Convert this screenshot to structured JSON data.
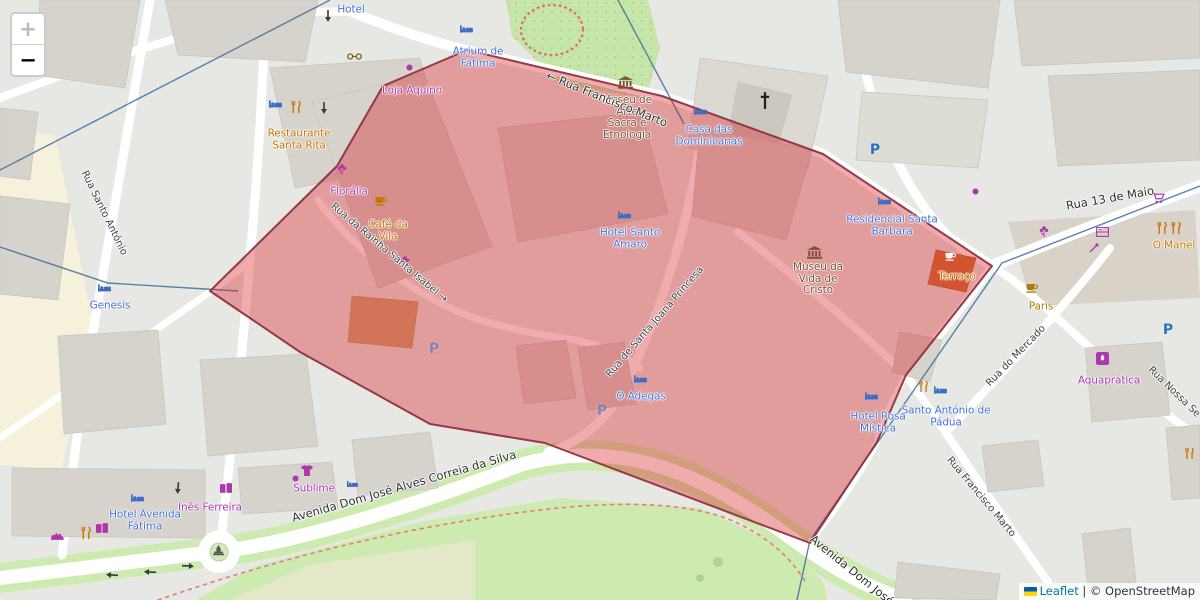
{
  "controls": {
    "zoom_in": "+",
    "zoom_out": "−"
  },
  "attribution": {
    "leaflet": "Leaflet",
    "separator": "|",
    "copyright": "© OpenStreetMap"
  },
  "parking": {
    "letter": "P"
  },
  "colors": {
    "polygon_fill": "#d61c20",
    "polygon_stroke": "#8c2a3a",
    "boundary_line": "#3c6e9f",
    "hotel_label": "#4670d2",
    "shop_label": "#ac39ac",
    "food_label": "#c77400",
    "museum_label": "#7c5034",
    "street_label": "#3e3e3e",
    "park_green": "#cdebb0",
    "building_gray": "#d6d3cd"
  },
  "streets": [
    {
      "name": "Rua Francisco Marto",
      "arrow": "←"
    },
    {
      "name": "Rua da Rainha Santa Isabel",
      "arrow": "→"
    },
    {
      "name": "Rua de Santa Joana Princesa"
    },
    {
      "name": "Avenida Dom José Alves Correia da Silva"
    },
    {
      "name": "Rua Santo António"
    },
    {
      "name": "Rua 13 de Maio"
    },
    {
      "name": "Rua do Mercado"
    },
    {
      "name": "Rua Nossa Se"
    },
    {
      "name": "Rua Francisco Marto"
    },
    {
      "name": "Avenida Dom José"
    }
  ],
  "pois": [
    {
      "name": "Hotel"
    },
    {
      "name": "Atrium de Fátima"
    },
    {
      "name": "Loja Aquino"
    },
    {
      "name": "Restaurante Santa Rita"
    },
    {
      "name": "Florália"
    },
    {
      "name": "Café da Vila"
    },
    {
      "name": "Museu de Arte Sacra e Etnologia"
    },
    {
      "name": "Casa das Dominicanas"
    },
    {
      "name": "Hotel Santo Amaro"
    },
    {
      "name": "Residencial Santa Barbara"
    },
    {
      "name": "Museu da Vida de Cristo"
    },
    {
      "name": "Terraço"
    },
    {
      "name": "O Manel"
    },
    {
      "name": "Paris"
    },
    {
      "name": "Aquaprática"
    },
    {
      "name": "Santo António de Pádua"
    },
    {
      "name": "Hotel Rosa Mística"
    },
    {
      "name": "O Adegas"
    },
    {
      "name": "Genesis"
    },
    {
      "name": "Inês Ferreira"
    },
    {
      "name": "Sublime"
    },
    {
      "name": "Hotel Avenida Fátima"
    }
  ],
  "icons": {
    "bed": "lodging pictogram",
    "cup": "café pictogram",
    "fork-knife": "restaurant pictogram",
    "museum": "museum columns pictogram",
    "flower": "florist pictogram",
    "shirt": "clothing-shop pictogram",
    "cart": "supermarket pictogram",
    "gift": "gift-shop pictogram",
    "cross": "church cross",
    "statue": "monument pictogram",
    "arrow": "one-way arrow",
    "flag": "ukraine-flag"
  }
}
